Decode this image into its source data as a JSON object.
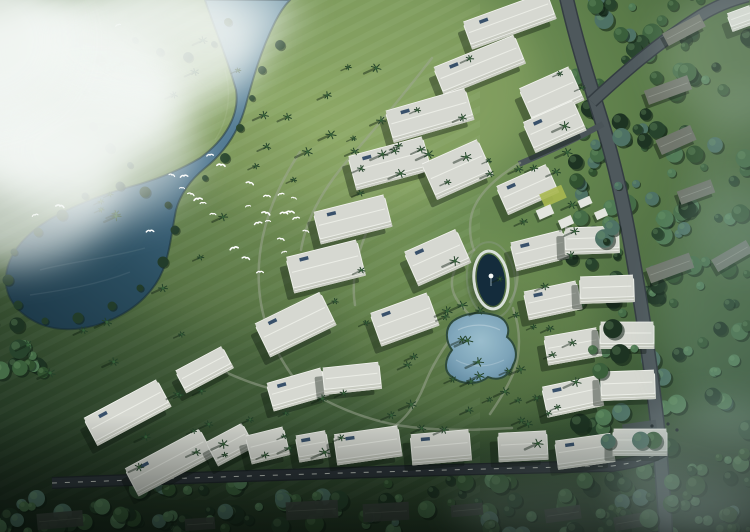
{
  "scene": {
    "width": 750,
    "height": 532,
    "description": "aerial-masterplan-rendering",
    "palette": {
      "grass_light": "#7e9b5f",
      "grass_mid": "#5f804c",
      "grass_dark": "#2c4630",
      "river_light": "#6f95a8",
      "river_mid": "#47708a",
      "lake_dark": "#1e3b4b",
      "forest": "#2c4834",
      "building": "#eceee8",
      "roof": "#d6d8d1",
      "facade_shade": "#c9ccc2",
      "road": "#4e585c",
      "road_dark": "#2c3339",
      "dash_line": "#d9ded7",
      "pool": "#7fa6bd",
      "oval_water": "#142c3c",
      "bird": "#ffffff",
      "cloud": "#f3f7f4",
      "panel_blue": "#39516b",
      "lawn_patch": "#a9b850",
      "house_roof": "#70756b",
      "dark_roof": "#3d453f"
    },
    "water": {
      "path": "M205,0 C215,30 228,60 236,90 C240,115 225,140 200,158 C180,170 160,178 140,184 C110,192 80,202 52,218 C28,232 8,252 6,276 C4,298 18,314 40,324 C62,333 90,330 115,318 C138,307 155,290 163,270 C170,252 172,230 176,210 C180,195 190,180 205,168 C225,152 238,132 245,108 C252,82 260,52 275,22 C282,8 288,2 290,0 Z",
      "ripples": [
        "M40,270 C70,262 110,258 145,248",
        "M30,295 C65,290 100,284 130,272",
        "M225,70 C232,95 228,120 215,140"
      ]
    },
    "rim_trees": [
      [
        168,
        205
      ],
      [
        175,
        230
      ],
      [
        163,
        262
      ],
      [
        140,
        288
      ],
      [
        112,
        306
      ],
      [
        78,
        318
      ],
      [
        45,
        321
      ],
      [
        18,
        305
      ],
      [
        8,
        280
      ],
      [
        14,
        252
      ],
      [
        38,
        232
      ],
      [
        62,
        215
      ],
      [
        85,
        196
      ],
      [
        120,
        186
      ],
      [
        145,
        192
      ]
    ],
    "bank_trees": [
      [
        252,
        98
      ],
      [
        240,
        128
      ],
      [
        225,
        158
      ],
      [
        205,
        178
      ],
      [
        262,
        70
      ],
      [
        280,
        45
      ],
      [
        135,
        40
      ],
      [
        160,
        52
      ],
      [
        188,
        57
      ],
      [
        214,
        44
      ],
      [
        228,
        22
      ],
      [
        100,
        60
      ],
      [
        85,
        92
      ],
      [
        93,
        126
      ],
      [
        110,
        148
      ],
      [
        130,
        165
      ]
    ],
    "forest_regions": [
      [
        572,
        -8,
        182,
        548,
        175,
        7
      ],
      [
        112,
        480,
        515,
        56,
        85,
        13
      ],
      [
        -8,
        496,
        130,
        42,
        22,
        19
      ],
      [
        -6,
        318,
        52,
        56,
        12,
        23
      ]
    ],
    "road_edge_regions": [
      [
        592,
        4,
        44,
        460,
        20,
        29
      ],
      [
        636,
        438,
        114,
        92,
        18,
        31
      ]
    ],
    "roads": {
      "main": "M566,-4 C576,40 588,78 600,116 C614,160 624,205 632,252 C640,298 648,348 654,396 C659,434 663,478 666,536",
      "branch": "M592,102 C620,76 656,44 700,16 C716,6 732,0 748,-4",
      "spur": "M603,124 C576,139 548,152 519,164",
      "bottom": "M52,483 C210,477 420,470 612,466 C634,463 652,458 666,450",
      "parking": [
        640,
        430,
        34,
        16,
        -8
      ]
    },
    "walkways": [
      "M520,163 C498,176 480,192 473,210 C468,224 470,240 474,250",
      "M474,250 C455,262 448,278 454,294 C458,304 466,310 470,316",
      "M470,316 C452,334 434,360 424,386 C416,406 404,420 392,428",
      "M512,252 C520,268 519,288 510,302",
      "M513,308 C521,330 521,354 513,374 C506,390 497,404 490,414",
      "M300,152 C272,194 256,240 259,286 C261,322 276,356 300,386",
      "M300,386 C332,406 362,418 396,425 C440,432 480,430 512,428",
      "M432,58 C404,94 374,130 348,160 C322,190 306,220 301,250",
      "M200,360 C232,376 256,386 282,391",
      "M380,205 C360,240 350,275 355,305"
    ],
    "buildings": [
      [
        510,
        22,
        90,
        26,
        -20,
        1
      ],
      [
        480,
        67,
        88,
        28,
        -22,
        1
      ],
      [
        430,
        117,
        84,
        30,
        -16,
        1
      ],
      [
        552,
        96,
        56,
        34,
        -24,
        0
      ],
      [
        555,
        128,
        56,
        30,
        -24,
        1
      ],
      [
        390,
        165,
        78,
        32,
        -15,
        1
      ],
      [
        458,
        171,
        62,
        36,
        -24,
        0
      ],
      [
        528,
        191,
        56,
        28,
        -24,
        1
      ],
      [
        353,
        221,
        74,
        30,
        -14,
        1
      ],
      [
        326,
        268,
        74,
        34,
        -14,
        1
      ],
      [
        438,
        259,
        58,
        34,
        -24,
        1
      ],
      [
        296,
        326,
        74,
        34,
        -26,
        1
      ],
      [
        405,
        321,
        62,
        32,
        -20,
        1
      ],
      [
        540,
        252,
        55,
        26,
        -14,
        1
      ],
      [
        592,
        242,
        55,
        24,
        -2,
        0
      ],
      [
        553,
        302,
        55,
        26,
        -12,
        1
      ],
      [
        607,
        291,
        55,
        24,
        -2,
        0
      ],
      [
        573,
        348,
        55,
        26,
        -10,
        0
      ],
      [
        627,
        337,
        55,
        24,
        0,
        1
      ],
      [
        573,
        398,
        58,
        28,
        -12,
        1
      ],
      [
        628,
        387,
        55,
        26,
        -2,
        0
      ],
      [
        585,
        453,
        58,
        26,
        -8,
        1
      ],
      [
        640,
        444,
        55,
        24,
        0,
        0
      ],
      [
        128,
        414,
        84,
        28,
        -28,
        1
      ],
      [
        170,
        464,
        86,
        28,
        -28,
        1
      ],
      [
        205,
        371,
        54,
        22,
        -28,
        0
      ],
      [
        231,
        446,
        42,
        24,
        -28,
        0
      ],
      [
        298,
        391,
        58,
        26,
        -16,
        1
      ],
      [
        352,
        380,
        58,
        24,
        -6,
        0
      ],
      [
        268,
        447,
        40,
        26,
        -14,
        0
      ],
      [
        313,
        448,
        32,
        24,
        -10,
        1
      ],
      [
        368,
        447,
        66,
        28,
        -8,
        1
      ],
      [
        441,
        449,
        60,
        28,
        -5,
        1
      ],
      [
        523,
        448,
        50,
        26,
        -3,
        0
      ],
      [
        742,
        20,
        26,
        16,
        -20,
        0
      ]
    ],
    "pavilions": [
      [
        545,
        212,
        16,
        10,
        -24
      ],
      [
        566,
        222,
        14,
        9,
        -24
      ],
      [
        585,
        202,
        13,
        8,
        -24
      ],
      [
        601,
        214,
        12,
        8,
        -24
      ]
    ],
    "lawn": [
      553,
      196,
      24,
      14,
      -24
    ],
    "houses": [
      [
        684,
        30,
        42,
        14,
        -28
      ],
      [
        668,
        90,
        46,
        15,
        -20
      ],
      [
        676,
        140,
        38,
        16,
        -24
      ],
      [
        696,
        192,
        36,
        14,
        -20
      ],
      [
        670,
        268,
        46,
        16,
        -20
      ],
      [
        732,
        256,
        40,
        14,
        -30
      ]
    ],
    "dark_roofs": [
      [
        312,
        510,
        52,
        18,
        -3
      ],
      [
        386,
        512,
        46,
        18,
        -3
      ],
      [
        467,
        510,
        32,
        12,
        -5
      ],
      [
        60,
        520,
        46,
        16,
        -5
      ],
      [
        563,
        514,
        36,
        14,
        -8
      ],
      [
        634,
        521,
        40,
        14,
        -10
      ],
      [
        200,
        524,
        30,
        12,
        -4
      ]
    ],
    "oval": {
      "cx": 491,
      "cy": 280,
      "rx": 14,
      "ry": 26,
      "rot": -6
    },
    "pool": {
      "path": "M453,321 C444,329 446,342 452,350 C445,359 443,371 452,377 C463,386 480,384 488,377 C500,382 510,375 513,365 C519,355 515,343 507,337 C511,327 505,317 494,315 C480,311 464,313 453,321 Z"
    },
    "palm_regions": [
      [
        250,
        62,
        170,
        145,
        12,
        11
      ],
      [
        85,
        190,
        180,
        115,
        8,
        22
      ],
      [
        12,
        300,
        180,
        75,
        6,
        33
      ],
      [
        285,
        55,
        300,
        360,
        46,
        44
      ],
      [
        200,
        398,
        350,
        58,
        18,
        55
      ],
      [
        90,
        358,
        160,
        110,
        10,
        66
      ],
      [
        430,
        298,
        115,
        95,
        12,
        77
      ],
      [
        95,
        12,
        150,
        105,
        6,
        88
      ]
    ],
    "birds": [
      [
        118,
        25
      ],
      [
        210,
        155
      ],
      [
        221,
        165
      ],
      [
        172,
        175
      ],
      [
        184,
        176
      ],
      [
        182,
        188
      ],
      [
        191,
        194
      ],
      [
        198,
        199
      ],
      [
        213,
        214
      ],
      [
        250,
        183
      ],
      [
        248,
        206
      ],
      [
        267,
        196
      ],
      [
        266,
        213
      ],
      [
        281,
        194
      ],
      [
        284,
        213
      ],
      [
        294,
        198
      ],
      [
        296,
        218
      ],
      [
        290,
        212
      ],
      [
        306,
        231
      ],
      [
        258,
        223
      ],
      [
        268,
        221
      ],
      [
        281,
        239
      ],
      [
        234,
        248
      ],
      [
        203,
        203
      ],
      [
        246,
        258
      ],
      [
        284,
        252
      ],
      [
        260,
        272
      ],
      [
        60,
        206
      ],
      [
        35,
        215
      ],
      [
        150,
        231
      ]
    ],
    "clouds": [
      [
        40,
        95,
        145,
        95,
        0.92
      ],
      [
        145,
        45,
        120,
        70,
        0.8
      ],
      [
        5,
        185,
        115,
        82,
        0.7
      ],
      [
        95,
        150,
        105,
        72,
        0.55
      ],
      [
        205,
        15,
        95,
        42,
        0.5
      ],
      [
        -20,
        40,
        90,
        80,
        0.8
      ]
    ],
    "haze": [
      [
        735,
        310,
        75,
        125,
        0.22,
        "#8fb0aa"
      ],
      [
        720,
        472,
        105,
        72,
        0.3,
        "#a8bdbb"
      ],
      [
        748,
        180,
        62,
        95,
        0.18,
        "#9db5ae"
      ],
      [
        733,
        55,
        75,
        70,
        0.22,
        "#cfe0d8"
      ],
      [
        600,
        505,
        150,
        42,
        0.18,
        "#9fb3b0"
      ]
    ],
    "glows": [
      [
        340,
        85,
        200,
        130,
        "#a9bf74",
        0.32
      ],
      [
        470,
        330,
        130,
        95,
        "#8fae63",
        0.28
      ],
      [
        250,
        200,
        180,
        130,
        "#93ad68",
        0.22
      ]
    ],
    "car": {
      "x": 626,
      "y": 35,
      "rot": -33,
      "color": "#2f6fd0"
    },
    "dots": [
      [
        668,
        424
      ],
      [
        677,
        430
      ],
      [
        661,
        432
      ],
      [
        652,
        426
      ]
    ]
  }
}
